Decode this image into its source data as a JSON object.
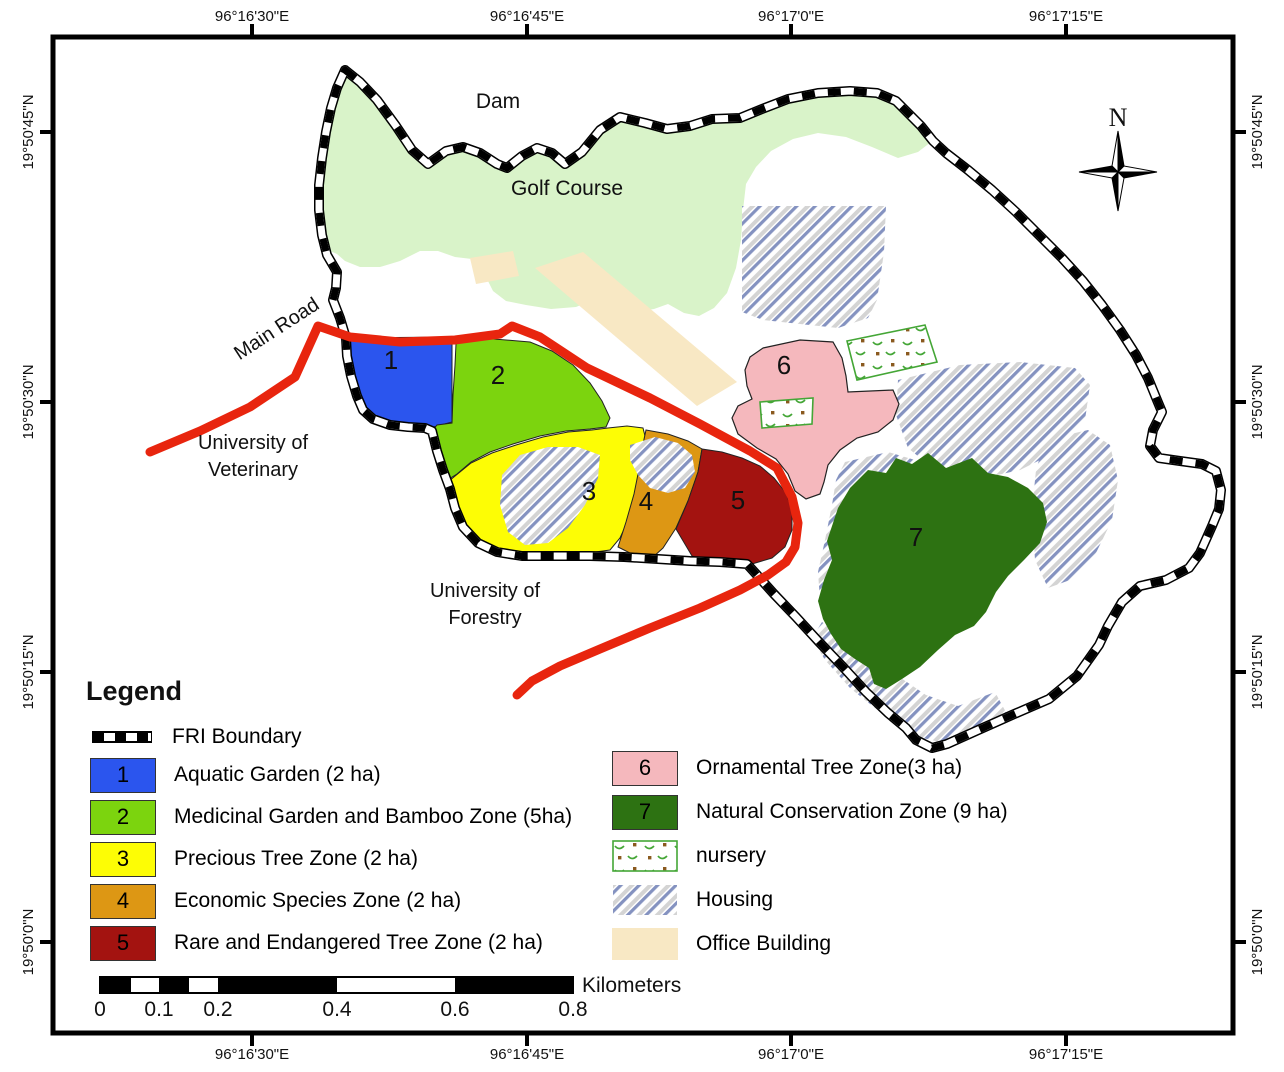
{
  "map": {
    "labels": {
      "dam": "Dam",
      "golf_course": "Golf Course",
      "main_road": "Main Road",
      "university_veterinary_line1": "University of",
      "university_veterinary_line2": "Veterinary",
      "university_forestry_line1": "University of",
      "university_forestry_line2": "Forestry",
      "north": "N"
    }
  },
  "axes": {
    "top": [
      "96°16'30\"E",
      "96°16'45\"E",
      "96°17'0\"E",
      "96°17'15\"E"
    ],
    "bottom": [
      "96°16'30\"E",
      "96°16'45\"E",
      "96°17'0\"E",
      "96°17'15\"E"
    ],
    "left": [
      "19°50'45\"N",
      "19°50'30\"N",
      "19°50'15\"N",
      "19°50'0\"N"
    ],
    "right": [
      "19°50'45\"N",
      "19°50'30\"N",
      "19°50'15\"N",
      "19°50'0\"N"
    ]
  },
  "legend": {
    "title": "Legend",
    "boundary_label": "FRI Boundary",
    "nursery_label": "nursery",
    "housing_label": "Housing",
    "office_label": "Office Building"
  },
  "zones": [
    {
      "num": "1",
      "label": "Aquatic Garden  (2 ha)",
      "color": "#2b55ee"
    },
    {
      "num": "2",
      "label": "Medicinal Garden and Bamboo Zone (5ha)",
      "color": "#7cd40e"
    },
    {
      "num": "3",
      "label": "Precious Tree Zone  (2 ha)",
      "color": "#fdfd05"
    },
    {
      "num": "4",
      "label": "Economic Species Zone  (2 ha)",
      "color": "#dd9714"
    },
    {
      "num": "5",
      "label": "Rare and Endangered Tree Zone  (2 ha)",
      "color": "#a31310"
    },
    {
      "num": "6",
      "label": "Ornamental Tree Zone(3 ha)",
      "color": "#f5b8bd"
    },
    {
      "num": "7",
      "label": "Natural Conservation Zone (9 ha)",
      "color": "#2d7212"
    }
  ],
  "scalebar": {
    "ticks": [
      "0",
      "0.1",
      "0.2",
      "0.4",
      "0.6",
      "0.8"
    ],
    "unit": "Kilometers"
  },
  "colors": {
    "golf_course": "#d9f3c9",
    "office_building": "#f8e8c4",
    "road": "#e8250e",
    "boundary": "#000000",
    "hatch_blue": "#8492c0",
    "hatch_gray": "#d4d4d4",
    "nursery_green": "#44a636",
    "nursery_brown": "#8a5a1f"
  }
}
